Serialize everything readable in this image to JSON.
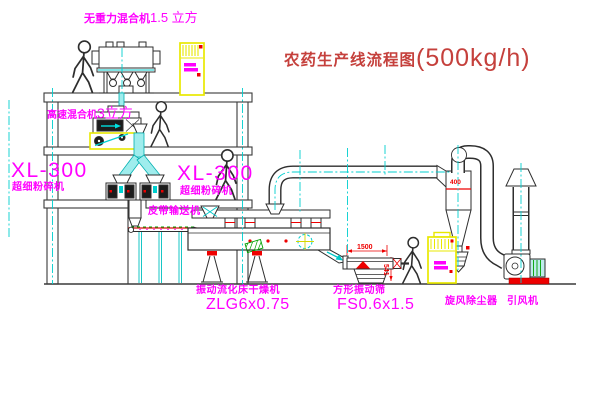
{
  "title": {
    "text": "农药生产线流程图",
    "capacity": "(500kg/h)"
  },
  "equipment": {
    "gravity_mixer": {
      "name": "无重力混合机",
      "spec": "1.5 立方"
    },
    "high_speed_mixer": {
      "name": "高速混合机",
      "spec": "3立方"
    },
    "pulverizer_left": {
      "model": "XL-300",
      "name": "超细粉碎机"
    },
    "pulverizer_right": {
      "model": "XL-300",
      "name": "超细粉碎机"
    },
    "belt_conveyor": {
      "name": "皮带输送机"
    },
    "fluid_bed_dryer": {
      "name": "振动流化床干燥机",
      "model": "ZLG6x0.75"
    },
    "square_sieve": {
      "name": "方形振动筛",
      "model": "FS0.6x1.5"
    },
    "cyclone": {
      "name": "旋风除尘器"
    },
    "induced_draft_fan": {
      "name": "引风机"
    }
  },
  "dimensions": {
    "sieve_length": "1500",
    "sieve_height": "541",
    "cyclone_inlet": "400"
  },
  "colors": {
    "label_magenta": "#FF00FF",
    "title_red": "#C5403C",
    "accent_red": "#EE0000",
    "line_cyan": "#00CFCF",
    "cabinet_yellow": "#E8E800",
    "machine_green": "#00A000"
  }
}
